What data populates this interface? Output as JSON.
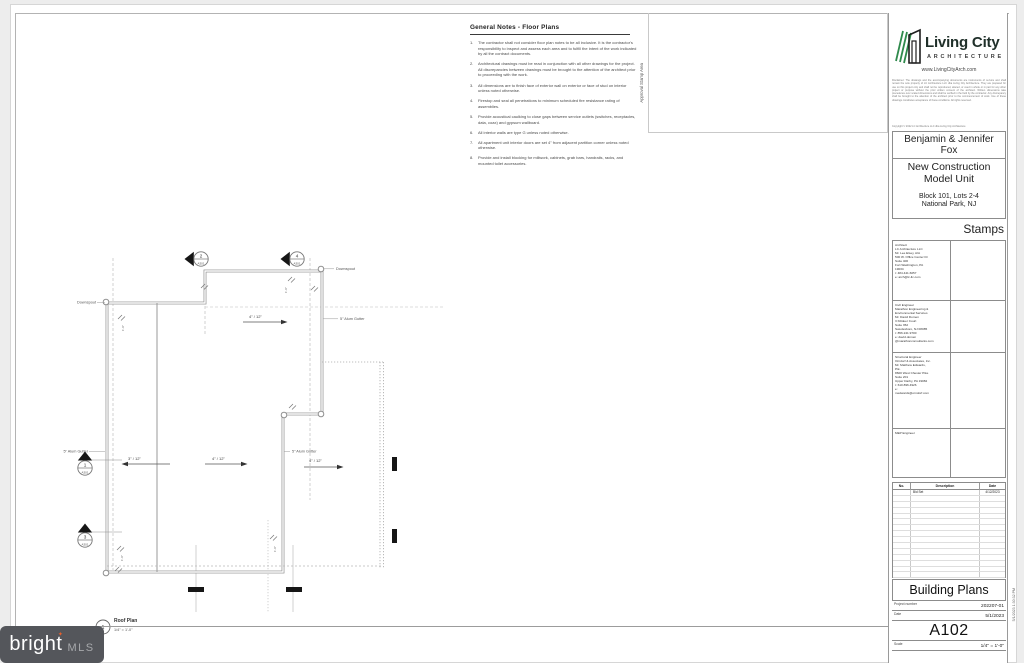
{
  "firm": {
    "name": "Living City",
    "tagline": "ARCHITECTURE",
    "website": "www.LivingCityArch.com",
    "disclaimer": "Disclaimer: The drawings and the accompanying documents are instruments of service and shall remain the sole property of LC Architecture LLC dba Living City Architecture. They are prepared for use on this project only and shall not be reproduced, altered, or used in whole or in part for any other project or purpose without the prior written consent of the architect. Written dimensions take precedence over scaled dimensions and shall be verified in the field by the contractor. Any discrepancy shall be brought to the attention of the architect prior to the commencement of work. Use of these drawings constitutes acceptance of these conditions. All rights reserved.",
    "copyright": "Copyright © 2022 LC Architecture LLC dba Living City Architecture"
  },
  "project": {
    "client_line1": "Benjamin  & Jennifer",
    "client_line2": "Fox",
    "title_line1": "New Construction",
    "title_line2": "Model Unit",
    "location_line1": "Block 101, Lots 2-4",
    "location_line2": "National Park, NJ"
  },
  "stamps": {
    "header": "Stamps",
    "architect": [
      "Architect",
      "LC Architecture LLC",
      "Mr. Lee Elsey, AIA",
      "500 W. Office Center Dr",
      "Suite 400",
      "Fort Washington, PA",
      "19034",
      "t: 484.441.6057",
      "e: arch@lc-llc.com"
    ],
    "civil": [
      "Civil Engineer",
      "Marathon Engineering &",
      "Environmental Services",
      "Mr. David Domen",
      "3 Killdeer Court",
      "Suite 352",
      "Swedesboro, NJ 08085",
      "t: 856.241.9700",
      "e: david.domen",
      "@marathonconsultants.com"
    ],
    "structural": [
      "Structural Engineer",
      "Orndorf & Associates, Inc.",
      "Mr. Matthew Edwards,",
      "P.E.",
      "8600 West Chester Pike",
      "Suite 201",
      "Upper Darby, PA 19082",
      "t: 610.896.4926",
      "e:",
      "medwards@orndorf.com"
    ],
    "mep": [
      "MEP Engineer"
    ]
  },
  "revisions": {
    "headers": [
      "No.",
      "Description",
      "Date"
    ],
    "rows": [
      {
        "no": "",
        "description": "Bid Set",
        "date": "4/12/2023"
      }
    ],
    "empty_row_count": 14
  },
  "titleblock": {
    "sheet_title": "Building Plans",
    "project_number_label": "Project number",
    "project_number": "202207-01",
    "date_label": "Date",
    "date": "5/1/2023",
    "sheet_number": "A102",
    "scale_label": "Scale",
    "scale": "1/4\" = 1'-0\"",
    "print_timestamp": "5/1/2023 1:30:32 PM"
  },
  "general_notes": {
    "title": "General Notes - Floor Plans",
    "items": [
      "The contractor shall not consider floor plan notes to be all inclusive. It is the contractor's responsibility to inspect and assess each area and to fulfill the intent of the work indicated by all the contract documents.",
      "Architectural drawings must be read in conjunction with all other drawings for the project. All discrepancies between drawings must be brought to the attention of the architect prior to proceeding with the work.",
      "All dimensions are to finish face of exterior wall on exterior or face of stud on interior unless noted otherwise.",
      "Firestop and seal all penetrations to minimum scheduled fire resistance rating of assemblies.",
      "Provide acoustical caulking to close gaps between service outlets (switches, receptacles, data, coax) and gypsum wallboard.",
      "All interior walls are type G unless noted otherwise.",
      "All apartment unit interior doors are set 4\" from adjacent partition corner unless noted otherwise.",
      "Provide and install blocking for millwork, cabinets, grab bars, handrails, racks, and mounted toilet accessories."
    ]
  },
  "approval": {
    "label": "Approval Stamp Area"
  },
  "plan": {
    "view_number": "1",
    "view_title": "Roof Plan",
    "view_scale": "1/4\" = 1'-0\"",
    "downspout_label": "Downspout",
    "gutter_label": "5\" Alum Gutter",
    "slope_4_12": "4\" / 12\"",
    "slope_3_12": "3\" / 12\"",
    "dim_1_0": "1'-0\"",
    "marker_sheet": "A301",
    "marker_1": "1",
    "marker_2": "2",
    "marker_3": "3",
    "marker_4": "4"
  },
  "watermark": {
    "brand": "bright",
    "suffix": "MLS"
  }
}
